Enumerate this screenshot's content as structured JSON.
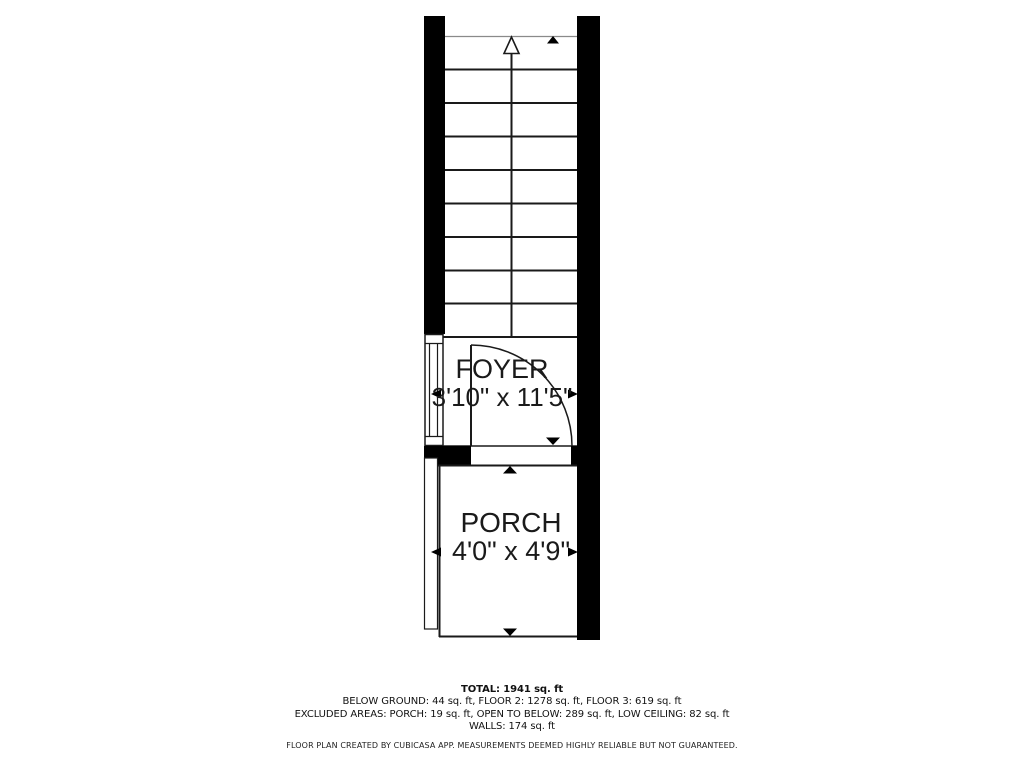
{
  "plan": {
    "rooms": {
      "foyer": {
        "label": "FOYER",
        "dims": "3'10\" x 11'5\""
      },
      "porch": {
        "label": "PORCH",
        "dims": "4'0\" x 4'9\""
      }
    },
    "summary": {
      "total": "TOTAL: 1941 sq. ft",
      "floors": "BELOW GROUND: 44 sq. ft, FLOOR 2: 1278 sq. ft, FLOOR 3: 619 sq. ft",
      "excluded": "EXCLUDED AREAS: PORCH: 19 sq. ft, OPEN TO BELOW: 289 sq. ft, LOW CEILING: 82 sq. ft",
      "walls": "WALLS: 174 sq. ft"
    },
    "disclaimer": "FLOOR PLAN CREATED BY CUBICASA APP. MEASUREMENTS DEEMED HIGHLY RELIABLE BUT NOT GUARANTEED.",
    "colors": {
      "wall": "#000000",
      "background": "#ffffff",
      "line": "#1a1a1a"
    }
  }
}
